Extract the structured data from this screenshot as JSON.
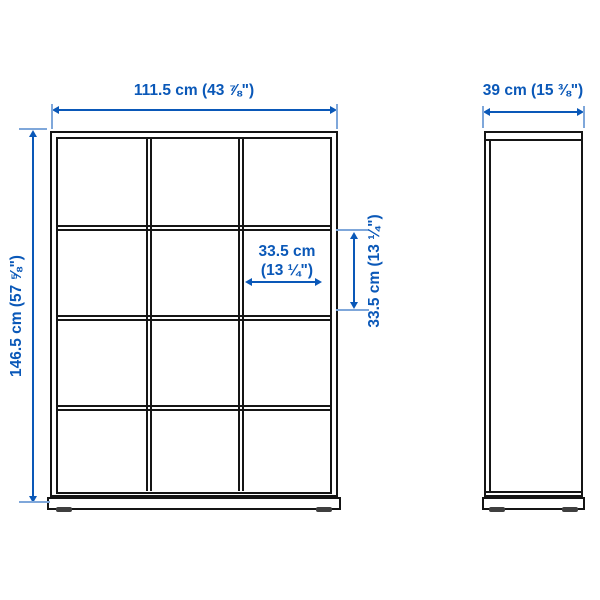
{
  "colors": {
    "accent_blue": "#0a58b8",
    "extension_tick_blue": "#7fa7da",
    "line_black": "#151515",
    "feet_gray": "#3f3f3f",
    "background": "#ffffff"
  },
  "front_view": {
    "grid_columns": 3,
    "grid_rows": 4,
    "dimensions": {
      "overall_width": {
        "label": "111.5 cm (43 ⅞\")"
      },
      "overall_height": {
        "label": "146.5 cm (57 ⅝\")"
      },
      "cell_width": {
        "label_line1": "33.5 cm",
        "label_line2": "(13 ¼\")"
      },
      "cell_height": {
        "label": "33.5 cm (13 ¼\")"
      }
    }
  },
  "side_view": {
    "dimensions": {
      "overall_depth": {
        "label": "39 cm (15 ⅜\")"
      }
    }
  }
}
